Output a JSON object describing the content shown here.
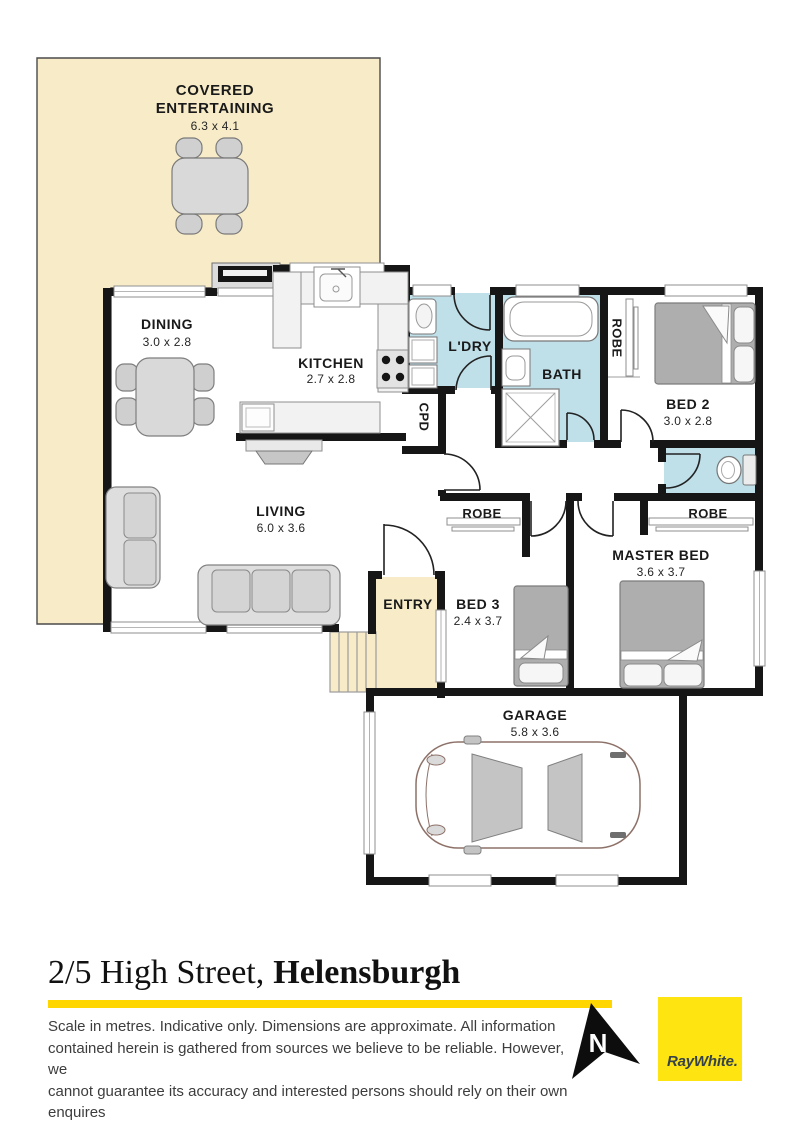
{
  "plan": {
    "rooms": {
      "covered": {
        "line1": "COVERED",
        "line2": "ENTERTAINING",
        "dims": "6.3 x 4.1"
      },
      "dining": {
        "name": "DINING",
        "dims": "3.0 x 2.8"
      },
      "kitchen": {
        "name": "KITCHEN",
        "dims": "2.7 x 2.8"
      },
      "laundry": {
        "name": "L'DRY"
      },
      "bath": {
        "name": "BATH"
      },
      "bed2": {
        "name": "BED 2",
        "dims": "3.0 x 2.8"
      },
      "living": {
        "name": "LIVING",
        "dims": "6.0 x 3.6"
      },
      "entry": {
        "name": "ENTRY"
      },
      "bed3": {
        "name": "BED 3",
        "dims": "2.4 x 3.7"
      },
      "master": {
        "name": "MASTER BED",
        "dims": "3.6 x 3.7"
      },
      "garage": {
        "name": "GARAGE",
        "dims": "5.8 x 3.6"
      }
    },
    "closets": {
      "robe_bed2": "ROBE",
      "robe_bed3": "ROBE",
      "robe_master": "ROBE",
      "cpd": "CPD"
    }
  },
  "footer": {
    "address": {
      "street": "2/5 High Street,",
      "suburb": "Helensburgh"
    },
    "disclaimer": [
      "Scale in metres. Indicative only. Dimensions are approximate. All information",
      "contained herein is gathered from sources we believe to be reliable. However, we",
      "cannot guarantee its accuracy and interested persons should rely on their own",
      "enquires"
    ],
    "north_label": "N",
    "brand": "RayWhite."
  },
  "colors": {
    "floor_highlight": "#f8ecc8",
    "wet_area": "#bfdfe9",
    "wall": "#161616",
    "accent_bar": "#ffd600",
    "brand_yellow": "#fee512",
    "brand_text": "#36424a"
  }
}
